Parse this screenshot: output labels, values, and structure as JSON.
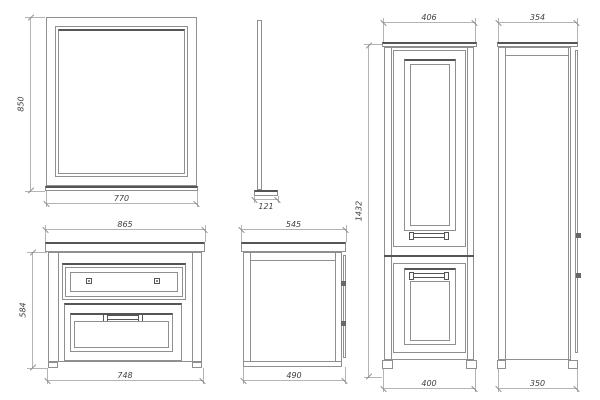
{
  "drawing": {
    "kind": "bathroom furniture dimensioned technical drawing",
    "views": {
      "mirror_front": {
        "height": "850",
        "width": "770"
      },
      "mirror_side": {
        "depth": "121"
      },
      "tall_cabinet_front": {
        "top_width": "406",
        "height": "1432",
        "bottom_width": "400"
      },
      "tall_cabinet_side": {
        "top_depth": "354",
        "bottom_depth": "350"
      },
      "vanity_front": {
        "top_width": "865",
        "height": "584",
        "bottom_width": "748"
      },
      "vanity_side": {
        "top_depth": "545",
        "bottom_depth": "490"
      }
    },
    "colors": {
      "background": "#ffffff",
      "object_line": "#8f8f8f",
      "accent_line": "#555555",
      "dimension_line": "#b4b4b4",
      "text": "#3f3f3f"
    }
  }
}
